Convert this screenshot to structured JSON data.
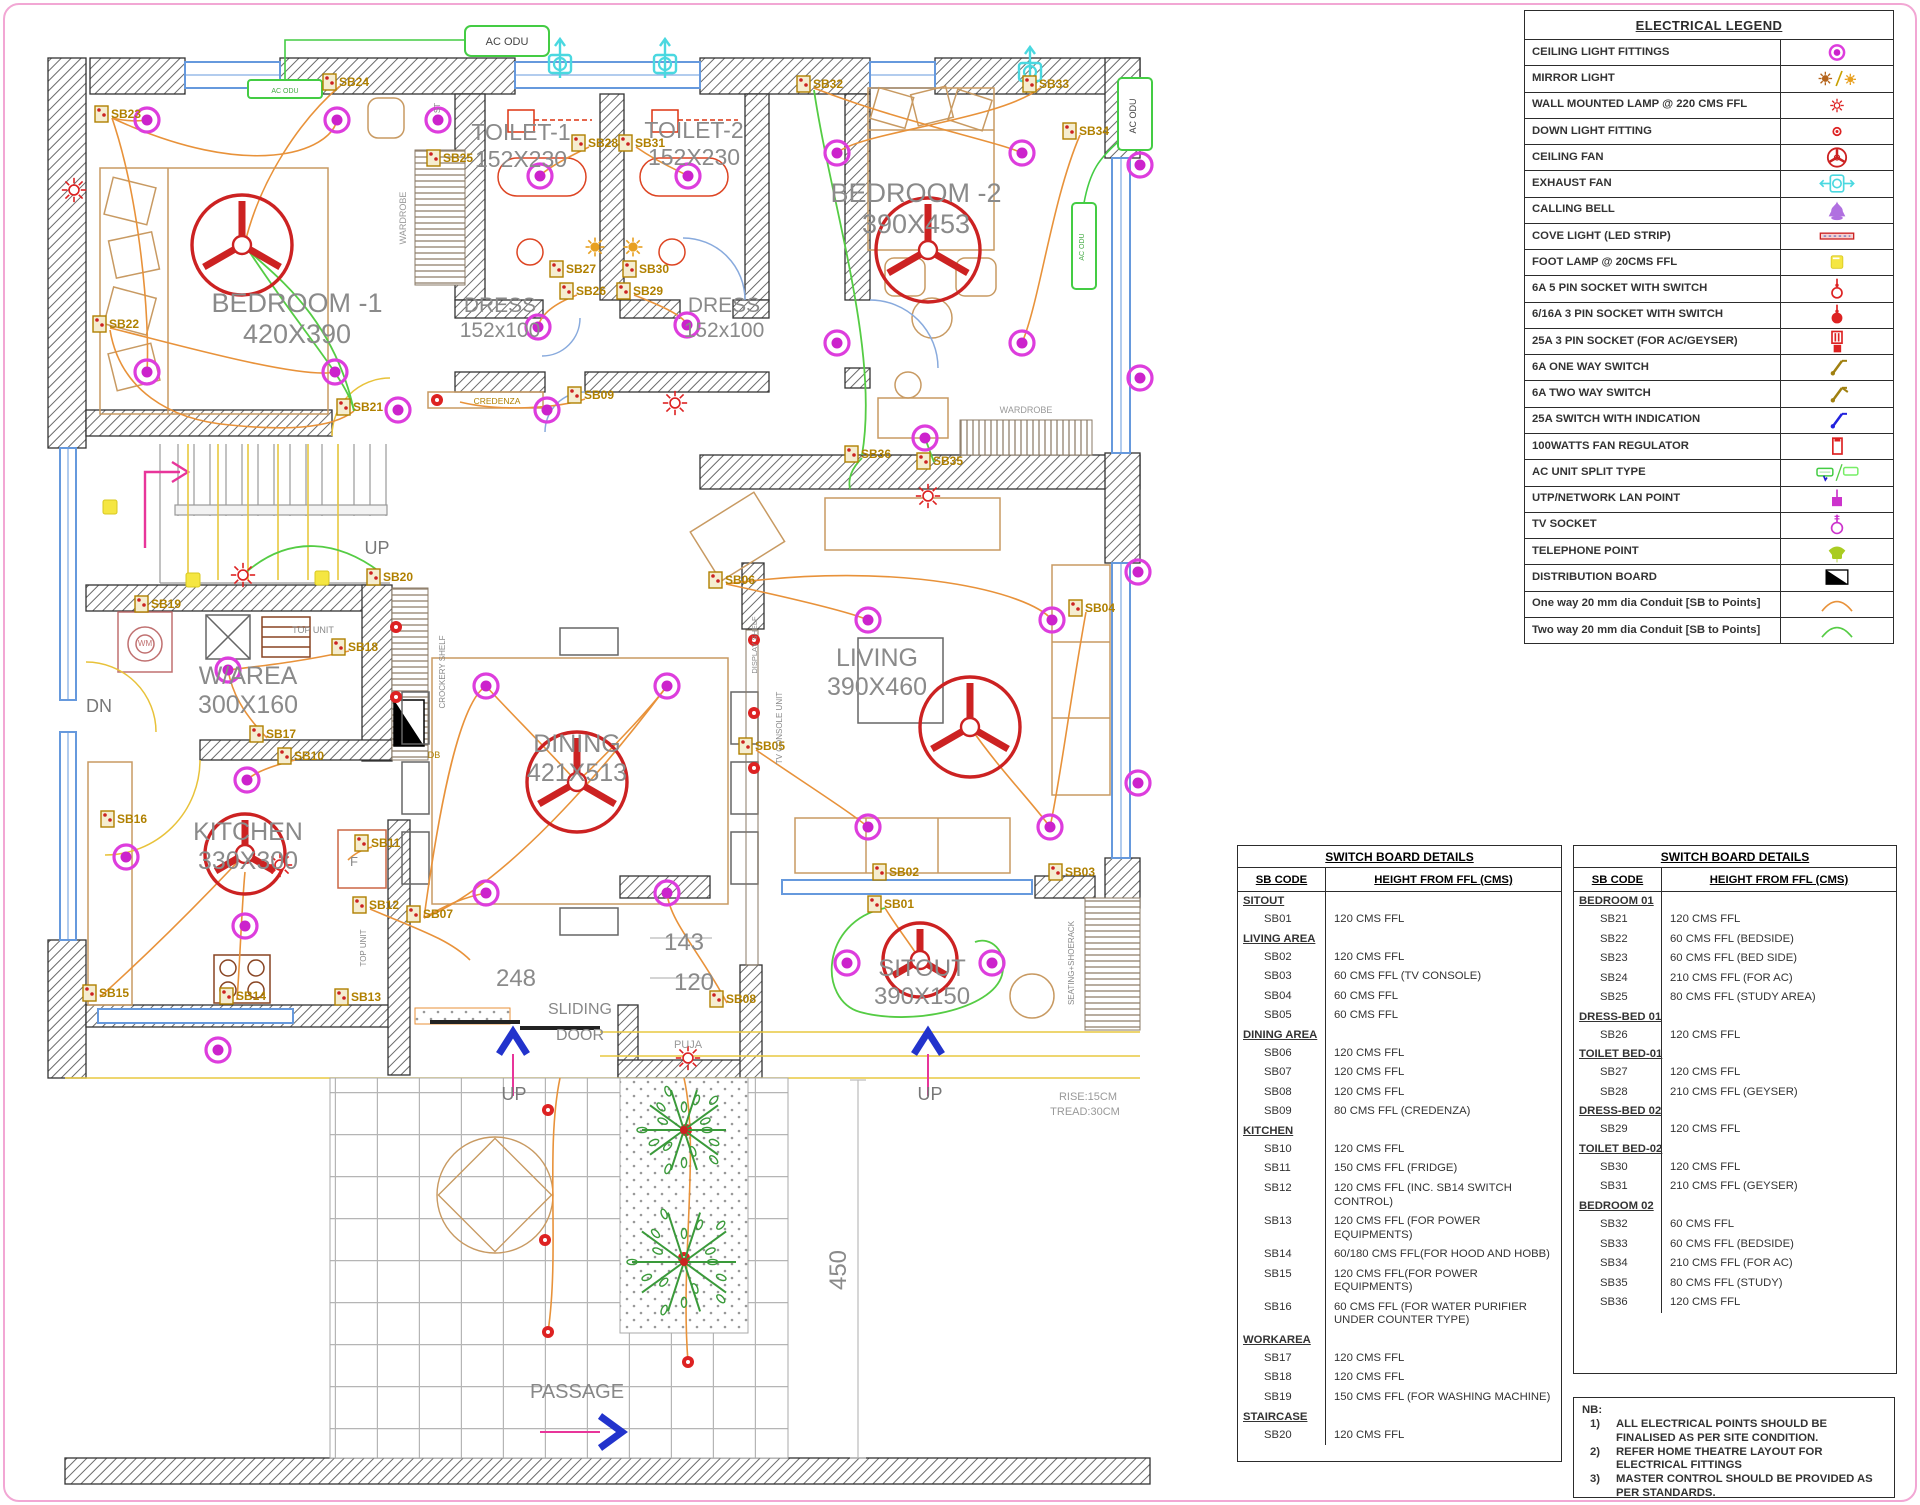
{
  "page": {
    "border_color": "#f2a7d4"
  },
  "legend": {
    "title": "ELECTRICAL LEGEND",
    "rows": [
      {
        "label": "CEILING LIGHT FITTINGS",
        "icon": "ceiling-light-icon"
      },
      {
        "label": "MIRROR LIGHT",
        "icon": "mirror-light-icon"
      },
      {
        "label": "WALL MOUNTED LAMP @ 220 CMS FFL",
        "icon": "wall-lamp-icon"
      },
      {
        "label": "DOWN LIGHT FITTING",
        "icon": "down-light-icon"
      },
      {
        "label": "CEILING FAN",
        "icon": "ceiling-fan-icon"
      },
      {
        "label": "EXHAUST FAN",
        "icon": "exhaust-fan-icon"
      },
      {
        "label": "CALLING BELL",
        "icon": "calling-bell-icon"
      },
      {
        "label": "COVE LIGHT (LED STRIP)",
        "icon": "cove-light-icon"
      },
      {
        "label": "FOOT LAMP @ 20CMS FFL",
        "icon": "foot-lamp-icon"
      },
      {
        "label": "6A 5 PIN SOCKET WITH SWITCH",
        "icon": "socket-5pin-icon"
      },
      {
        "label": "6/16A 3 PIN SOCKET WITH SWITCH",
        "icon": "socket-3pin-icon"
      },
      {
        "label": "25A 3 PIN SOCKET (FOR AC/GEYSER)",
        "icon": "socket-25a-icon"
      },
      {
        "label": "6A ONE WAY SWITCH",
        "icon": "switch-1way-icon"
      },
      {
        "label": "6A TWO WAY SWITCH",
        "icon": "switch-2way-icon"
      },
      {
        "label": "25A SWITCH WITH INDICATION",
        "icon": "switch-25a-icon"
      },
      {
        "label": "100WATTS FAN REGULATOR",
        "icon": "fan-regulator-icon"
      },
      {
        "label": "AC UNIT SPLIT TYPE",
        "icon": "ac-unit-icon"
      },
      {
        "label": "UTP/NETWORK LAN POINT",
        "icon": "lan-point-icon"
      },
      {
        "label": "TV SOCKET",
        "icon": "tv-socket-icon"
      },
      {
        "label": "TELEPHONE POINT",
        "icon": "telephone-point-icon"
      },
      {
        "label": "DISTRIBUTION BOARD",
        "icon": "distribution-board-icon"
      },
      {
        "label": "One way 20 mm dia Conduit [SB to Points]",
        "icon": "conduit-1way-icon"
      },
      {
        "label": "Two way 20 mm dia Conduit [SB to Points]",
        "icon": "conduit-2way-icon"
      }
    ]
  },
  "switch_board_tables": [
    {
      "title": "SWITCH BOARD DETAILS",
      "col1": "SB CODE",
      "col2": "HEIGHT FROM FFL (CMS)",
      "groups": [
        {
          "name": "SITOUT",
          "rows": [
            [
              "SB01",
              "120 CMS FFL"
            ]
          ]
        },
        {
          "name": "LIVING AREA",
          "rows": [
            [
              "SB02",
              "120 CMS FFL"
            ],
            [
              "SB03",
              "60 CMS FFL (TV CONSOLE)"
            ],
            [
              "SB04",
              "60 CMS FFL"
            ],
            [
              "SB05",
              "60 CMS FFL"
            ]
          ]
        },
        {
          "name": "DINING AREA",
          "rows": [
            [
              "SB06",
              "120 CMS FFL"
            ],
            [
              "SB07",
              "120 CMS FFL"
            ],
            [
              "SB08",
              "120 CMS FFL"
            ],
            [
              "SB09",
              "80 CMS FFL (CREDENZA)"
            ]
          ]
        },
        {
          "name": "KITCHEN",
          "rows": [
            [
              "SB10",
              "120 CMS FFL"
            ],
            [
              "SB11",
              "150 CMS FFL (FRIDGE)"
            ],
            [
              "SB12",
              "120 CMS FFL (INC. SB14 SWITCH CONTROL)"
            ],
            [
              "SB13",
              "120 CMS FFL (FOR POWER EQUIPMENTS)"
            ],
            [
              "SB14",
              "60/180 CMS FFL(FOR HOOD AND HOBB)"
            ],
            [
              "SB15",
              "120 CMS FFL(FOR POWER EQUIPMENTS)"
            ],
            [
              "SB16",
              "60 CMS FFL (FOR WATER PURIFIER UNDER COUNTER TYPE)"
            ]
          ]
        },
        {
          "name": "WORKAREA",
          "rows": [
            [
              "SB17",
              "120 CMS FFL"
            ],
            [
              "SB18",
              "120 CMS FFL"
            ],
            [
              "SB19",
              "150 CMS FFL (FOR WASHING MACHINE)"
            ]
          ]
        },
        {
          "name": "STAIRCASE",
          "rows": [
            [
              "SB20",
              "120 CMS FFL"
            ]
          ]
        }
      ]
    },
    {
      "title": "SWITCH BOARD DETAILS",
      "col1": "SB CODE",
      "col2": "HEIGHT FROM FFL (CMS)",
      "groups": [
        {
          "name": "BEDROOM 01",
          "rows": [
            [
              "SB21",
              "120 CMS FFL"
            ],
            [
              "SB22",
              "60 CMS FFL (BEDSIDE)"
            ],
            [
              "SB23",
              "60 CMS FFL (BED SIDE)"
            ],
            [
              "SB24",
              "210 CMS FFL (FOR AC)"
            ],
            [
              "SB25",
              "80 CMS FFL (STUDY AREA)"
            ]
          ]
        },
        {
          "name": "DRESS-BED 01",
          "rows": [
            [
              "SB26",
              "120 CMS FFL"
            ]
          ]
        },
        {
          "name": "TOILET BED-01",
          "rows": [
            [
              "SB27",
              "120 CMS FFL"
            ],
            [
              "SB28",
              "210 CMS FFL (GEYSER)"
            ]
          ]
        },
        {
          "name": "DRESS-BED 02",
          "rows": [
            [
              "SB29",
              "120 CMS FFL"
            ]
          ]
        },
        {
          "name": "TOILET BED-02",
          "rows": [
            [
              "SB30",
              "120 CMS FFL"
            ],
            [
              "SB31",
              "210 CMS FFL (GEYSER)"
            ]
          ]
        },
        {
          "name": "BEDROOM 02",
          "rows": [
            [
              "SB32",
              "60 CMS FFL"
            ],
            [
              "SB33",
              "60 CMS FFL (BEDSIDE)"
            ],
            [
              "SB34",
              "210 CMS FFL (FOR AC)"
            ],
            [
              "SB35",
              "80 CMS FFL (STUDY)"
            ],
            [
              "SB36",
              "120 CMS FFL"
            ]
          ]
        }
      ]
    }
  ],
  "notes": {
    "heading": "NB:",
    "items": [
      "ALL ELECTRICAL POINTS SHOULD BE FINALISED AS PER SITE CONDITION.",
      "REFER HOME THEATRE LAYOUT FOR ELECTRICAL FITTINGS",
      "MASTER CONTROL SHOULD BE PROVIDED AS PER STANDARDS."
    ]
  },
  "plan": {
    "rooms": [
      {
        "name": "BEDROOM -1",
        "dim": "420X390",
        "x": 297,
        "y": 312,
        "s": 27
      },
      {
        "name": "TOILET-1",
        "dim": "152X230",
        "x": 521,
        "y": 140,
        "s": 23
      },
      {
        "name": "TOILET-2",
        "dim": "152X230",
        "x": 694,
        "y": 138,
        "s": 23
      },
      {
        "name": "DRESS",
        "dim": "152x100",
        "x": 500,
        "y": 312,
        "s": 21
      },
      {
        "name": "DRESS",
        "dim": "152x100",
        "x": 724,
        "y": 312,
        "s": 21
      },
      {
        "name": "BEDROOM -2",
        "dim": "390X453",
        "x": 916,
        "y": 202,
        "s": 27
      },
      {
        "name": "W/AREA",
        "dim": "300X160",
        "x": 248,
        "y": 684,
        "s": 25
      },
      {
        "name": "KITCHEN",
        "dim": "330X300",
        "x": 248,
        "y": 840,
        "s": 25
      },
      {
        "name": "DINING",
        "dim": "421X513",
        "x": 577,
        "y": 752,
        "s": 25
      },
      {
        "name": "LIVING",
        "dim": "390X460",
        "x": 877,
        "y": 666,
        "s": 25
      },
      {
        "name": "SITOUT",
        "dim": "390X150",
        "x": 922,
        "y": 976,
        "s": 24
      }
    ],
    "labels": [
      {
        "t": "UP",
        "x": 377,
        "y": 554,
        "s": 18,
        "c": "#777"
      },
      {
        "t": "UP",
        "x": 514,
        "y": 1100,
        "s": 18,
        "c": "#777"
      },
      {
        "t": "UP",
        "x": 930,
        "y": 1100,
        "s": 18,
        "c": "#777"
      },
      {
        "t": "DN",
        "x": 99,
        "y": 712,
        "s": 18,
        "c": "#777"
      },
      {
        "t": "SLIDING",
        "x": 580,
        "y": 1014,
        "s": 16,
        "c": "#888"
      },
      {
        "t": "DOOR",
        "x": 580,
        "y": 1040,
        "s": 16,
        "c": "#888"
      },
      {
        "t": "PASSAGE",
        "x": 577,
        "y": 1398,
        "s": 20,
        "c": "#888"
      },
      {
        "t": "248",
        "x": 516,
        "y": 986,
        "s": 24,
        "c": "#8a8a8a"
      },
      {
        "t": "143",
        "x": 684,
        "y": 950,
        "s": 24,
        "c": "#8a8a8a"
      },
      {
        "t": "120",
        "x": 694,
        "y": 990,
        "s": 24,
        "c": "#8a8a8a"
      },
      {
        "t": "450",
        "x": 846,
        "y": 1270,
        "s": 24,
        "c": "#8a8a8a",
        "r": -90
      },
      {
        "t": "RISE:15CM",
        "x": 1088,
        "y": 1100,
        "s": 11,
        "c": "#999"
      },
      {
        "t": "TREAD:30CM",
        "x": 1085,
        "y": 1115,
        "s": 11,
        "c": "#999"
      },
      {
        "t": "WARDROBE",
        "x": 406,
        "y": 218,
        "s": 9,
        "c": "#999",
        "r": -90
      },
      {
        "t": "WARDROBE",
        "x": 1026,
        "y": 413,
        "s": 9,
        "c": "#999"
      },
      {
        "t": "CREDENZA",
        "x": 497,
        "y": 404,
        "s": 8.5,
        "c": "#b08000"
      },
      {
        "t": "TOP UNIT",
        "x": 313,
        "y": 633,
        "s": 9,
        "c": "#888"
      },
      {
        "t": "TOP UNIT",
        "x": 366,
        "y": 948,
        "s": 8,
        "c": "#888",
        "r": -90
      },
      {
        "t": "CROCKERY SHELF",
        "x": 445,
        "y": 672,
        "s": 8,
        "c": "#888",
        "r": -90
      },
      {
        "t": "DISPLAY SHELF",
        "x": 757,
        "y": 645,
        "s": 7.5,
        "c": "#888",
        "r": -90
      },
      {
        "t": "TV CONSOLE UNIT",
        "x": 782,
        "y": 728,
        "s": 8,
        "c": "#888",
        "r": -90
      },
      {
        "t": "SEATING+SHOERACK",
        "x": 1074,
        "y": 963,
        "s": 8,
        "c": "#888",
        "r": -90
      },
      {
        "t": "ST",
        "x": 440,
        "y": 108,
        "s": 8,
        "c": "#888",
        "r": -90
      },
      {
        "t": "PUJA",
        "x": 688,
        "y": 1048,
        "s": 11,
        "c": "#999"
      },
      {
        "t": "WM",
        "x": 145,
        "y": 646,
        "s": 8,
        "c": "#c07070"
      },
      {
        "t": "F",
        "x": 354,
        "y": 866,
        "s": 13,
        "c": "#888"
      },
      {
        "t": "DB",
        "x": 434,
        "y": 758,
        "s": 9,
        "c": "#b08000"
      },
      {
        "t": "AC ODU",
        "x": 507,
        "y": 45,
        "s": 11,
        "c": "#444"
      },
      {
        "t": "AC ODU",
        "x": 285,
        "y": 93,
        "s": 7,
        "c": "#44aa44"
      },
      {
        "t": "AC ODU",
        "x": 1136,
        "y": 116,
        "s": 9,
        "c": "#444",
        "r": -90
      },
      {
        "t": "AC ODU",
        "x": 1084,
        "y": 247,
        "s": 7,
        "c": "#44aa44",
        "r": -90
      }
    ],
    "sb_labels": [
      {
        "code": "SB01",
        "x": 885,
        "y": 908
      },
      {
        "code": "SB02",
        "x": 890,
        "y": 876
      },
      {
        "code": "SB03",
        "x": 1066,
        "y": 876
      },
      {
        "code": "SB04",
        "x": 1086,
        "y": 612
      },
      {
        "code": "SB05",
        "x": 756,
        "y": 750
      },
      {
        "code": "SB06",
        "x": 726,
        "y": 584
      },
      {
        "code": "SB07",
        "x": 424,
        "y": 918
      },
      {
        "code": "SB08",
        "x": 727,
        "y": 1003
      },
      {
        "code": "SB09",
        "x": 585,
        "y": 399
      },
      {
        "code": "SB10",
        "x": 295,
        "y": 760
      },
      {
        "code": "SB11",
        "x": 372,
        "y": 847
      },
      {
        "code": "SB12",
        "x": 370,
        "y": 909
      },
      {
        "code": "SB13",
        "x": 352,
        "y": 1001
      },
      {
        "code": "SB14",
        "x": 237,
        "y": 1000
      },
      {
        "code": "SB15",
        "x": 100,
        "y": 997
      },
      {
        "code": "SB16",
        "x": 118,
        "y": 823
      },
      {
        "code": "SB17",
        "x": 267,
        "y": 738
      },
      {
        "code": "SB18",
        "x": 349,
        "y": 651
      },
      {
        "code": "SB19",
        "x": 152,
        "y": 608
      },
      {
        "code": "SB20",
        "x": 384,
        "y": 581
      },
      {
        "code": "SB21",
        "x": 354,
        "y": 411
      },
      {
        "code": "SB22",
        "x": 110,
        "y": 328
      },
      {
        "code": "SB23",
        "x": 112,
        "y": 118
      },
      {
        "code": "SB24",
        "x": 340,
        "y": 86
      },
      {
        "code": "SB25",
        "x": 444,
        "y": 162
      },
      {
        "code": "SB26",
        "x": 577,
        "y": 295
      },
      {
        "code": "SB27",
        "x": 567,
        "y": 273
      },
      {
        "code": "SB28",
        "x": 589,
        "y": 147
      },
      {
        "code": "SB29",
        "x": 634,
        "y": 295
      },
      {
        "code": "SB30",
        "x": 640,
        "y": 273
      },
      {
        "code": "SB31",
        "x": 636,
        "y": 147
      },
      {
        "code": "SB32",
        "x": 814,
        "y": 88
      },
      {
        "code": "SB33",
        "x": 1040,
        "y": 88
      },
      {
        "code": "SB34",
        "x": 1080,
        "y": 135
      },
      {
        "code": "SB35",
        "x": 934,
        "y": 465
      },
      {
        "code": "SB36",
        "x": 862,
        "y": 458
      }
    ],
    "lights": [
      [
        147,
        120
      ],
      [
        337,
        120
      ],
      [
        147,
        372
      ],
      [
        335,
        372
      ],
      [
        438,
        120
      ],
      [
        540,
        176
      ],
      [
        688,
        176
      ],
      [
        538,
        327
      ],
      [
        687,
        325
      ],
      [
        837,
        153
      ],
      [
        1022,
        153
      ],
      [
        837,
        343
      ],
      [
        1022,
        343
      ],
      [
        925,
        438
      ],
      [
        1140,
        165
      ],
      [
        1140,
        378
      ],
      [
        1138,
        572
      ],
      [
        1138,
        783
      ],
      [
        868,
        620
      ],
      [
        1052,
        620
      ],
      [
        868,
        827
      ],
      [
        1050,
        827
      ],
      [
        486,
        686
      ],
      [
        667,
        686
      ],
      [
        486,
        893
      ],
      [
        667,
        893
      ],
      [
        398,
        410
      ],
      [
        547,
        410
      ],
      [
        228,
        670
      ],
      [
        247,
        780
      ],
      [
        245,
        926
      ],
      [
        126,
        857
      ],
      [
        218,
        1050
      ],
      [
        847,
        963
      ],
      [
        992,
        963
      ]
    ],
    "fans": [
      [
        242,
        245,
        50
      ],
      [
        928,
        250,
        52
      ],
      [
        577,
        782,
        50
      ],
      [
        970,
        727,
        50
      ],
      [
        245,
        854,
        40
      ],
      [
        920,
        960,
        37
      ]
    ],
    "exhaust_fans": [
      [
        560,
        64
      ],
      [
        665,
        64
      ],
      [
        1030,
        72
      ]
    ],
    "wall_lamps": [
      [
        74,
        190
      ],
      [
        675,
        403
      ],
      [
        928,
        496
      ],
      [
        280,
        865
      ],
      [
        688,
        1058
      ],
      [
        243,
        575
      ]
    ],
    "mirror_lamps": [
      [
        595,
        247
      ],
      [
        633,
        247
      ]
    ],
    "foot_lamps": [
      [
        110,
        507
      ],
      [
        193,
        580
      ],
      [
        322,
        578
      ]
    ],
    "down_lights": [
      [
        548,
        1110
      ],
      [
        545,
        1240
      ],
      [
        548,
        1332
      ],
      [
        686,
        1130
      ],
      [
        684,
        1258
      ],
      [
        688,
        1362
      ],
      [
        396,
        627
      ],
      [
        396,
        697
      ],
      [
        754,
        640
      ],
      [
        754,
        713
      ],
      [
        754,
        768
      ],
      [
        437,
        400
      ]
    ],
    "trees": [
      [
        684,
        1130,
        42
      ],
      [
        684,
        1262,
        52
      ]
    ],
    "colors": {
      "light": "#dd3ddd",
      "fan": "#cc2222",
      "conduit1": "#e8923a",
      "conduit2": "#55cc44",
      "exhaust": "#4ad8e0",
      "window": "#6699dd",
      "ac": "#44cc44",
      "sb_text": "#b08000",
      "room_text": "#8a8a8a",
      "arrow_blue": "#2233cc",
      "arrow_pink": "#e8359a"
    }
  }
}
